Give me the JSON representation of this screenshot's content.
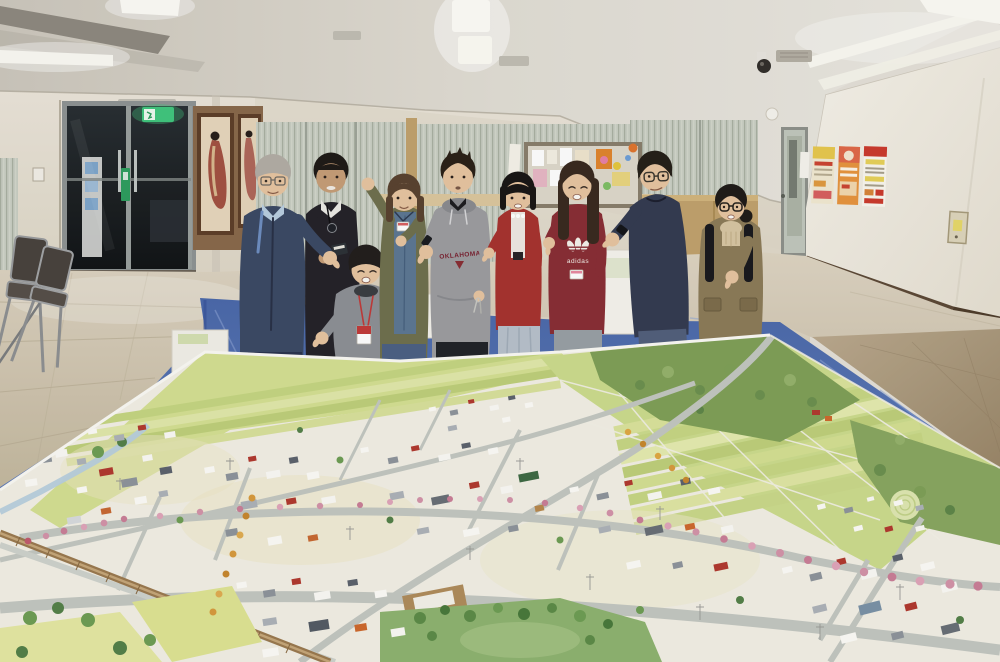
{
  "scene": {
    "type": "photograph",
    "summary": "Nine smiling people stand in a fluorescent-lit community room behind a huge hand-painted scale model of a town laid on a blue tarp on the floor, all pointing toward the camera."
  },
  "texts": {
    "hoodie_print": "OKLAHOMA",
    "sweatshirt_brand": "adidas"
  },
  "palette": {
    "ceiling": "#dcd7cd",
    "backwall": "#e8e2d5",
    "soffit": "#ded7c9",
    "rightwall": "#f3efe6",
    "floor": "#cfc5b1",
    "carpet": "#b2a084",
    "tarp": "#5574b4",
    "tarplight": "#7e96cb",
    "modelbase": "#f3f0e6",
    "fieldgreen": "#d5e093",
    "fielddark": "#c0d27c",
    "hillgreen": "#80a158",
    "roadgray": "#c4c8c2",
    "cherry": "#d494aa",
    "rail": "#9b7a50",
    "park": "#8fb471",
    "exitgreen": "#42c77e",
    "wood": "#8a6a4c",
    "blinds": "#c9cec3",
    "partition": "#c2a36e",
    "skin": "#e8c6a2",
    "skintan": "#c79e78",
    "p1jacket": "#3c4b66",
    "p1shirt": "#b9cfe2",
    "p2jacket": "#26242a",
    "p3top": "#8e9196",
    "p4cardigan": "#70714f",
    "p4denim": "#5d7894",
    "p5hoodie": "#9d9da0",
    "p6cardigan": "#a83430",
    "p6skirt": "#b8c2cc",
    "p7sweat": "#8a2f36",
    "p7skirt": "#99a0a6",
    "p8sweater": "#353c52",
    "p8jeans": "#53617c",
    "p9jacket": "#8d7c59",
    "p9knit": "#d8c7a4"
  },
  "room": {
    "lighting": "recessed fluorescent strip lights",
    "features": [
      "glass entrance doors with dark interior",
      "green emergency exit sign over door",
      "two framed portrait paintings on wood panel",
      "vertical blinds along back windows",
      "cork notice board with colorful flyers and dot magnets",
      "tan partition boards",
      "three promotional posters on right wall",
      "small notice sheets taped to wall",
      "pale green service door",
      "wall intercom panel",
      "ceiling security camera",
      "air vents",
      "stacked folding chairs",
      "light switch plate"
    ]
  },
  "people": [
    {
      "position": "1 far left",
      "hair": "gray",
      "eyewear": "silver glasses",
      "top": "navy work jacket over light-blue shirt",
      "bottom": "dark navy trousers",
      "accessories": [
        "blue lanyard"
      ],
      "pose": "pointing at camera"
    },
    {
      "position": "2 second from left",
      "hair": "black short",
      "eyewear": "none",
      "top": "black jacket over white shirt",
      "bottom": "dark trousers",
      "accessories": [
        "neck badge reel",
        "dark name badge in hand"
      ],
      "pose": "holding badge toward camera"
    },
    {
      "position": "3 crouching front",
      "hair": "black bob",
      "eyewear": "none",
      "top": "gray sweatshirt with dark turtleneck",
      "bottom": "crouched",
      "accessories": [
        "red lanyard with badge"
      ],
      "pose": "pointing at camera"
    },
    {
      "position": "4 center-left",
      "hair": "brown long",
      "eyewear": "none",
      "top": "olive cardigan over denim shirt",
      "bottom": "jeans",
      "accessories": [
        "white name badge"
      ],
      "pose": "fist raised and pointing"
    },
    {
      "position": "5 center",
      "hair": "dark spiky",
      "eyewear": "none",
      "top": "gray OKLAHOMA hoodie over black tee",
      "bottom": "black jeans",
      "accessories": [
        "black watch",
        "belt keys"
      ],
      "pose": "pointing at camera"
    },
    {
      "position": "6 center-right",
      "hair": "black bob with bangs",
      "eyewear": "none",
      "top": "red cardigan over white lace top",
      "bottom": "pale blue-gray pleated skirt",
      "accessories": [],
      "pose": "pointing at camera"
    },
    {
      "position": "7 right of center",
      "hair": "long dark brown",
      "eyewear": "none",
      "top": "maroon adidas trefoil sweatshirt",
      "bottom": "gray skirt with black tights",
      "accessories": [
        "white name badge"
      ],
      "pose": "pointing at camera"
    },
    {
      "position": "8 second from right",
      "hair": "dark mop",
      "eyewear": "round glasses",
      "top": "dark navy crewneck",
      "bottom": "jeans",
      "accessories": [
        "black watch"
      ],
      "pose": "arm stretched pointing"
    },
    {
      "position": "9 far right",
      "hair": "dark with ponytail",
      "eyewear": "black glasses",
      "top": "khaki utility jacket over beige turtleneck",
      "bottom": "dark trousers",
      "accessories": [
        "black backpack straps"
      ],
      "pose": "pointing at camera"
    }
  ],
  "model": {
    "ground": "blue plastic tarp on floor",
    "features": [
      "grid of yellow-green farm fields",
      "dark green wooded hill at far right",
      "dense low-rise town blocks in white, gray, red and orange",
      "avenue lined with pink cherry-blossom trees",
      "diagonal railway line with tan station",
      "pale blue river",
      "green park with clustered trees",
      "orange autumn street trees",
      "tiny power poles"
    ]
  }
}
